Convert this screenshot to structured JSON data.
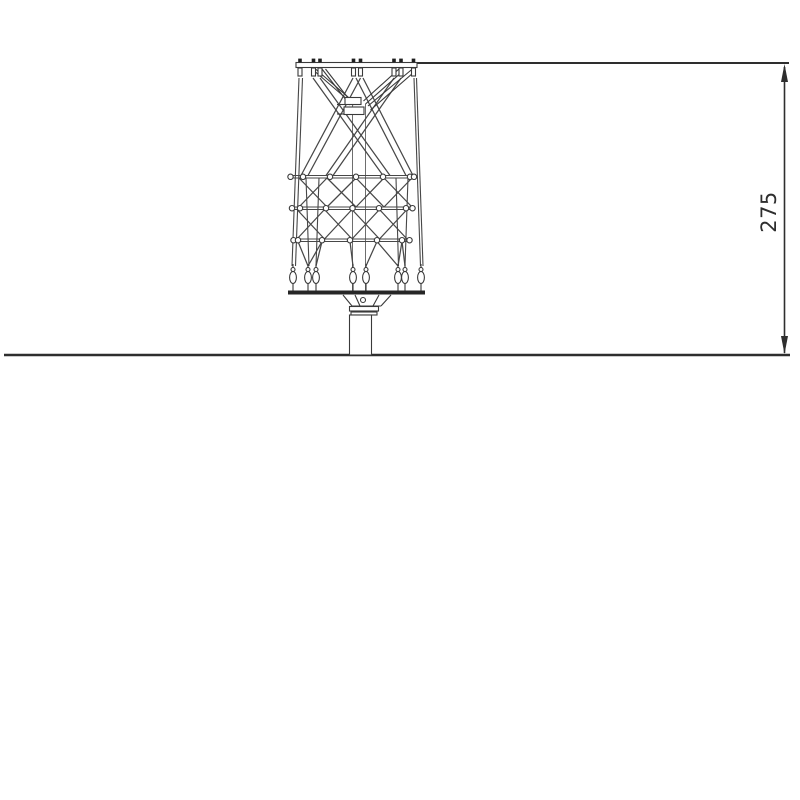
{
  "dimension": {
    "height_label": "275"
  },
  "colors": {
    "line": "#3a3a3a",
    "ground_line": "#2e2e2e",
    "background": "#ffffff"
  }
}
